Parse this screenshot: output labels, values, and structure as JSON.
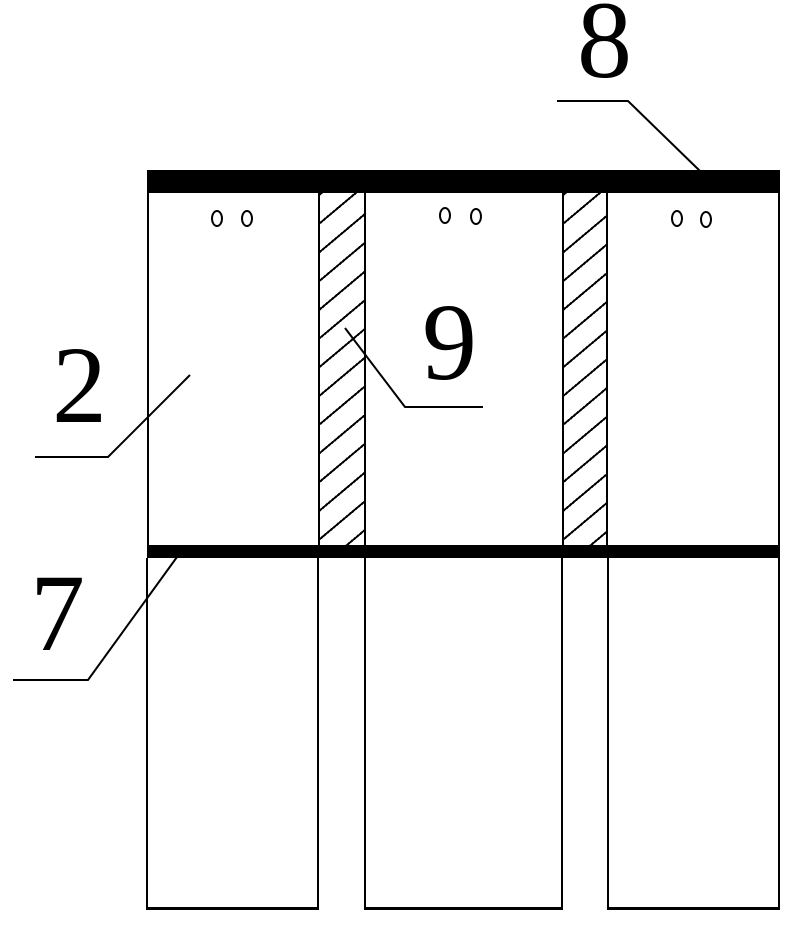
{
  "figure_labels": {
    "top_plate": "8",
    "panel": "2",
    "middle_plate": "7",
    "hatched_column": "9"
  },
  "colors": {
    "ink": "#000000",
    "paper": "#ffffff"
  }
}
